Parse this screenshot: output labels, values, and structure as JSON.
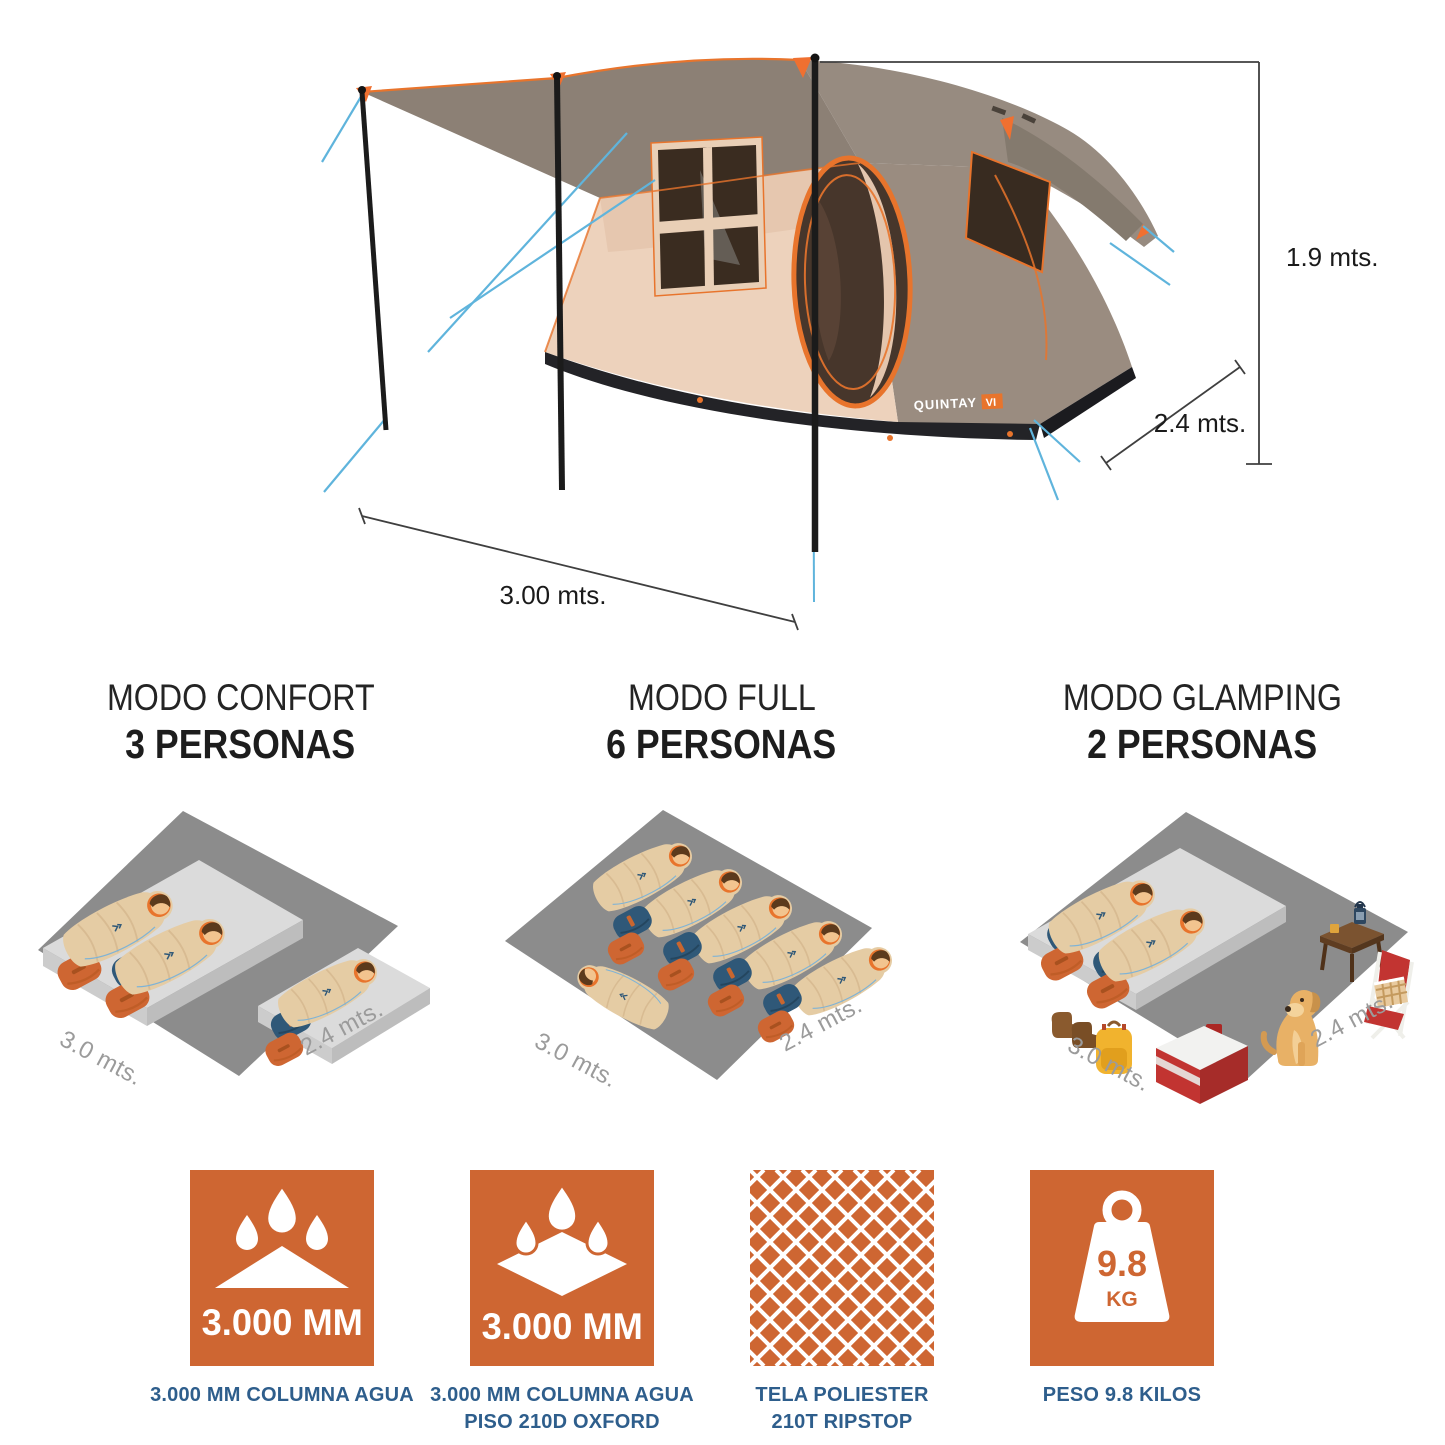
{
  "page": {
    "background": "#FFFFFF"
  },
  "hero": {
    "brand": {
      "name": "QUINTAY",
      "model": "VI"
    },
    "dimensions": {
      "height_label": "1.9 mts.",
      "depth_label": "2.4 mts.",
      "width_label": "3.00 mts."
    }
  },
  "modes": [
    {
      "title": "MODO CONFORT",
      "capacity": "3 PERSONAS",
      "floor_width_label": "3.0 mts.",
      "floor_depth_label": "2.4 mts."
    },
    {
      "title": "MODO FULL",
      "capacity": "6 PERSONAS",
      "floor_width_label": "3.0 mts.",
      "floor_depth_label": "2.4 mts."
    },
    {
      "title": "MODO GLAMPING",
      "capacity": "2 PERSONAS",
      "floor_width_label": "3.0 mts.",
      "floor_depth_label": "2.4 mts."
    }
  ],
  "features": [
    {
      "icon": "rain-drops-roof-icon",
      "value": "3.000 MM",
      "caption_line1": "3.000 MM COLUMNA AGUA",
      "caption_line2": ""
    },
    {
      "icon": "rain-drops-floor-icon",
      "value": "3.000 MM",
      "caption_line1": "3.000 MM COLUMNA AGUA",
      "caption_line2": "PISO 210D OXFORD"
    },
    {
      "icon": "ripstop-weave-icon",
      "value": "",
      "caption_line1": "TELA POLIESTER",
      "caption_line2": "210T RIPSTOP"
    },
    {
      "icon": "weight-icon",
      "value": "9.8",
      "unit": "KG",
      "caption_line1": "PESO 9.8 KILOS",
      "caption_line2": ""
    }
  ],
  "colors": {
    "accent_orange": "#CE6632",
    "trim_orange": "#E8742C",
    "caption_navy": "#2E5E8C",
    "fly_taupe": "#8C8075",
    "wall_beige": "#EDD2BC",
    "floor_gray": "#8C8C8C",
    "guyline_blue": "#5FB4DC",
    "dimension_text": "#1A1A1A",
    "scene_label_gray": "#9B9B9B"
  }
}
